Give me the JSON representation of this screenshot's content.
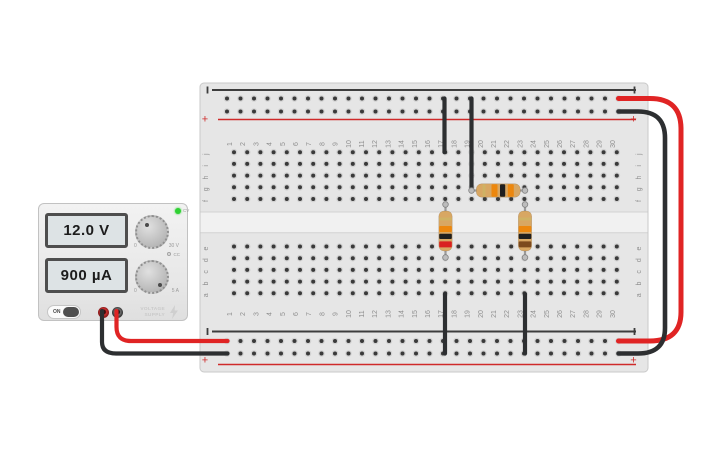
{
  "power_supply": {
    "voltage_display": "12.0 V",
    "current_display": "900 µA",
    "voltage_knob": {
      "min_label": "0",
      "max_label": "30 V",
      "status_label": "CV",
      "status_led_color": "#2fd133"
    },
    "current_knob": {
      "min_label": "0",
      "max_label": "5 A",
      "status_label": "CC"
    },
    "power_toggle_label": "ON",
    "brand_line1": "VOLTAGE",
    "brand_line2": "SUPPLY",
    "positive_terminal_color": "#d03030",
    "negative_terminal_color": "#3c3c3c"
  },
  "breadboard": {
    "column_labels": [
      "1",
      "2",
      "3",
      "4",
      "5",
      "6",
      "7",
      "8",
      "9",
      "10",
      "11",
      "12",
      "13",
      "14",
      "15",
      "16",
      "17",
      "18",
      "19",
      "20",
      "21",
      "22",
      "23",
      "24",
      "25",
      "26",
      "27",
      "28",
      "29",
      "30"
    ],
    "row_labels_top": [
      "j",
      "i",
      "h",
      "g",
      "f"
    ],
    "row_labels_bottom": [
      "e",
      "d",
      "c",
      "b",
      "a"
    ],
    "rail_positive_symbol": "+",
    "rail_negative_symbol": "−",
    "positive_rail_color": "#cf2a2a",
    "negative_rail_color": "#3d3d3d"
  },
  "circuit": {
    "wires": [
      {
        "name": "wire-power-positive",
        "color": "#2d2f31",
        "width": 4.2,
        "path": "M102,311 L102,342 Q102,353.5 116,353.5 L227.5,353.5"
      },
      {
        "name": "wire-power-negative",
        "color": "#e02424",
        "width": 4.2,
        "path": "M116.5,311 L116.5,327 Q116.5,341 131,341 L227.5,341"
      },
      {
        "name": "wire-rail-jumper-negative",
        "color": "#e02424",
        "width": 5,
        "path": "M618.5,98.5 L650,98.5 Q681,98.5 681,129 L681,312 Q681,341 650,341 L618.5,341"
      },
      {
        "name": "wire-rail-jumper-positive",
        "color": "#2d2f31",
        "width": 4.6,
        "path": "M618.5,111.5 L638,111.5 Q665,111.5 665,138 L665,328 Q665,353.5 638,353.5 L618.5,353.5"
      },
      {
        "name": "wire-top-rail-to-col17",
        "color": "#2d2f31",
        "width": 4.2,
        "path": "M444.5,98.5 L444.5,152.2"
      },
      {
        "name": "wire-top-rail-to-col19",
        "color": "#2d2f31",
        "width": 4.2,
        "path": "M471.5,98.5 L471.5,190.5"
      },
      {
        "name": "wire-bottom-rail-to-col17",
        "color": "#2d2f31",
        "width": 4.2,
        "path": "M445,294 L445,353.5"
      },
      {
        "name": "wire-bottom-rail-to-col23",
        "color": "#2d2f31",
        "width": 4.2,
        "path": "M525,294 L525,353.5"
      }
    ],
    "resistors": [
      {
        "name": "resistor-horizontal",
        "body_color": "#d8a763",
        "band_colors": [
          "#cfb264",
          "#ec870e",
          "#1f1f1f",
          "#ec870e"
        ],
        "lead": {
          "x1": 471.5,
          "y1": 190.5,
          "x2": 525,
          "y2": 190.5
        },
        "body": {
          "x": 476.3,
          "y": 183.8,
          "w": 44,
          "h": 13.4
        },
        "bands": [
          {
            "x": 482.5,
            "y": 184.2,
            "w": 3,
            "h": 12.6
          },
          {
            "x": 491.5,
            "y": 184.2,
            "w": 6,
            "h": 12.6
          },
          {
            "x": 500,
            "y": 184.2,
            "w": 5.2,
            "h": 12.6
          },
          {
            "x": 507.8,
            "y": 184.2,
            "w": 6,
            "h": 12.6
          }
        ]
      },
      {
        "name": "resistor-left-vertical",
        "body_color": "#d8a763",
        "band_colors": [
          "#cfb264",
          "#ec870e",
          "#1f1f1f",
          "#d92020"
        ],
        "lead": {
          "x1": 445.5,
          "y1": 204.5,
          "x2": 445.5,
          "y2": 257.5
        },
        "body": {
          "x": 438.8,
          "y": 211,
          "w": 13.4,
          "h": 40
        },
        "bands": [
          {
            "x": 439.2,
            "y": 217.5,
            "w": 12.6,
            "h": 3
          },
          {
            "x": 439.2,
            "y": 226,
            "w": 12.6,
            "h": 6
          },
          {
            "x": 439.2,
            "y": 233.8,
            "w": 12.6,
            "h": 5.2
          },
          {
            "x": 439.2,
            "y": 241.4,
            "w": 12.6,
            "h": 6
          }
        ]
      },
      {
        "name": "resistor-right-vertical",
        "body_color": "#d8a763",
        "band_colors": [
          "#cfb264",
          "#ec870e",
          "#1f1f1f",
          "#7c4a1e"
        ],
        "lead": {
          "x1": 525,
          "y1": 204.5,
          "x2": 525,
          "y2": 257.5
        },
        "body": {
          "x": 518.3,
          "y": 211,
          "w": 13.4,
          "h": 40
        },
        "bands": [
          {
            "x": 518.7,
            "y": 217.5,
            "w": 12.6,
            "h": 3
          },
          {
            "x": 518.7,
            "y": 226,
            "w": 12.6,
            "h": 6
          },
          {
            "x": 518.7,
            "y": 233.8,
            "w": 12.6,
            "h": 5.2
          },
          {
            "x": 518.7,
            "y": 241.4,
            "w": 12.6,
            "h": 6
          }
        ]
      }
    ]
  }
}
